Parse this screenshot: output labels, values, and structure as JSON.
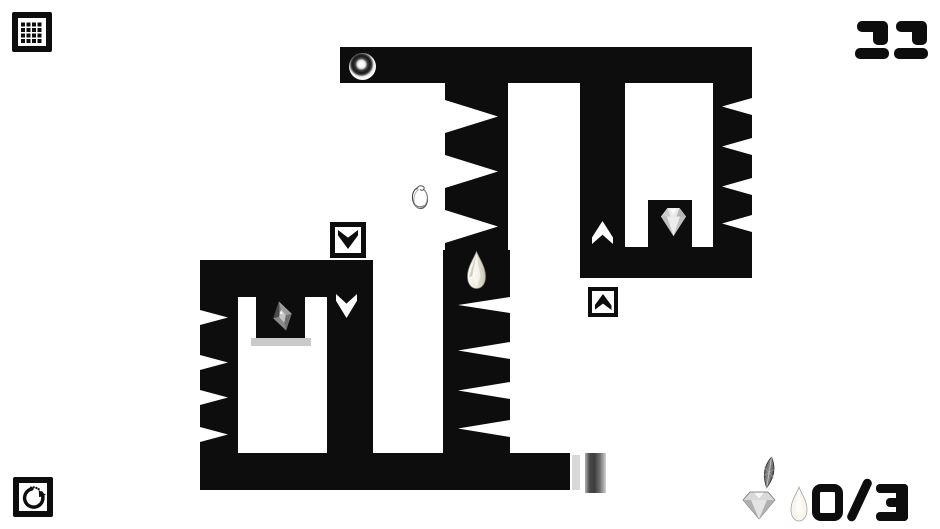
{
  "hud": {
    "level": "22",
    "gems_collected": "0",
    "gems_total": "3",
    "counter_separator": "/",
    "gem_counter": "0/3",
    "menu_label": "level menu",
    "restart_label": "restart level"
  },
  "colors": {
    "ink": "#0d0d0d",
    "background": "#ffffff",
    "pillar_dark": "#3c3c3c",
    "pillar_light": "#d5d5d5",
    "alcove_shadow": "#cacaca"
  },
  "icons": {
    "menu": "grid-menu-icon",
    "restart": "restart-arrow-icon",
    "portal": "portal-hole-icon",
    "switch_down": "arrow-down-switch-icon",
    "switch_up": "arrow-up-switch-icon",
    "indicator_down": "arrow-down-indicator-icon",
    "indicator_up": "arrow-up-indicator-icon",
    "gem_rhombus": "rhombus-gem-icon",
    "gem_teardrop": "teardrop-gem-icon",
    "gem_diamond": "diamond-gem-icon",
    "character": "doodle-character-sprite",
    "exit_pillar": "gradient-pillar"
  }
}
